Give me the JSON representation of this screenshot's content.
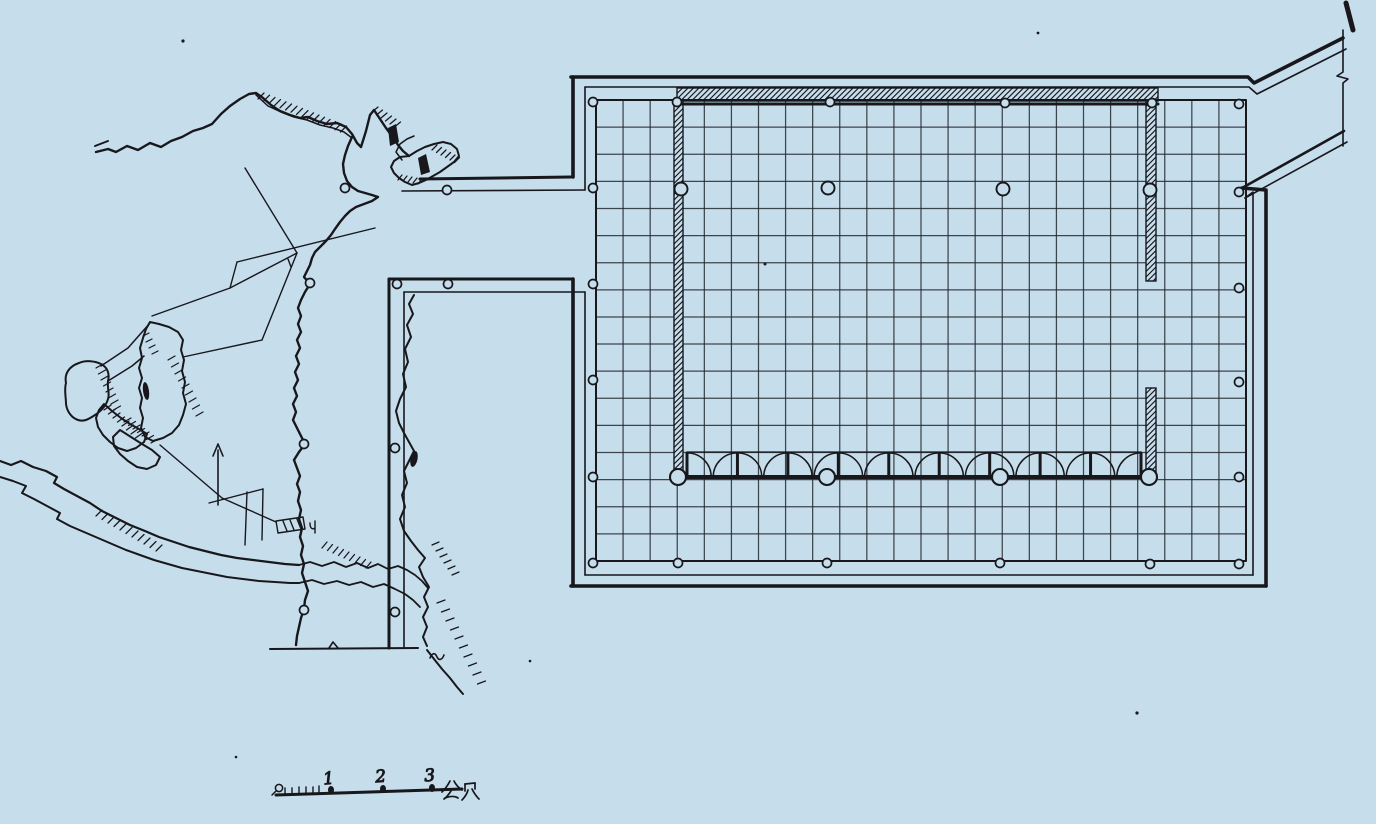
{
  "drawing": {
    "kind": "hand-drawn architectural plan",
    "colors": {
      "paper": "#c6ddeb",
      "ink": "#17171c"
    }
  },
  "scale_bar": {
    "zero_label": "0",
    "tick_labels": [
      "1",
      "2",
      "3"
    ],
    "unit_label": "公尺"
  }
}
